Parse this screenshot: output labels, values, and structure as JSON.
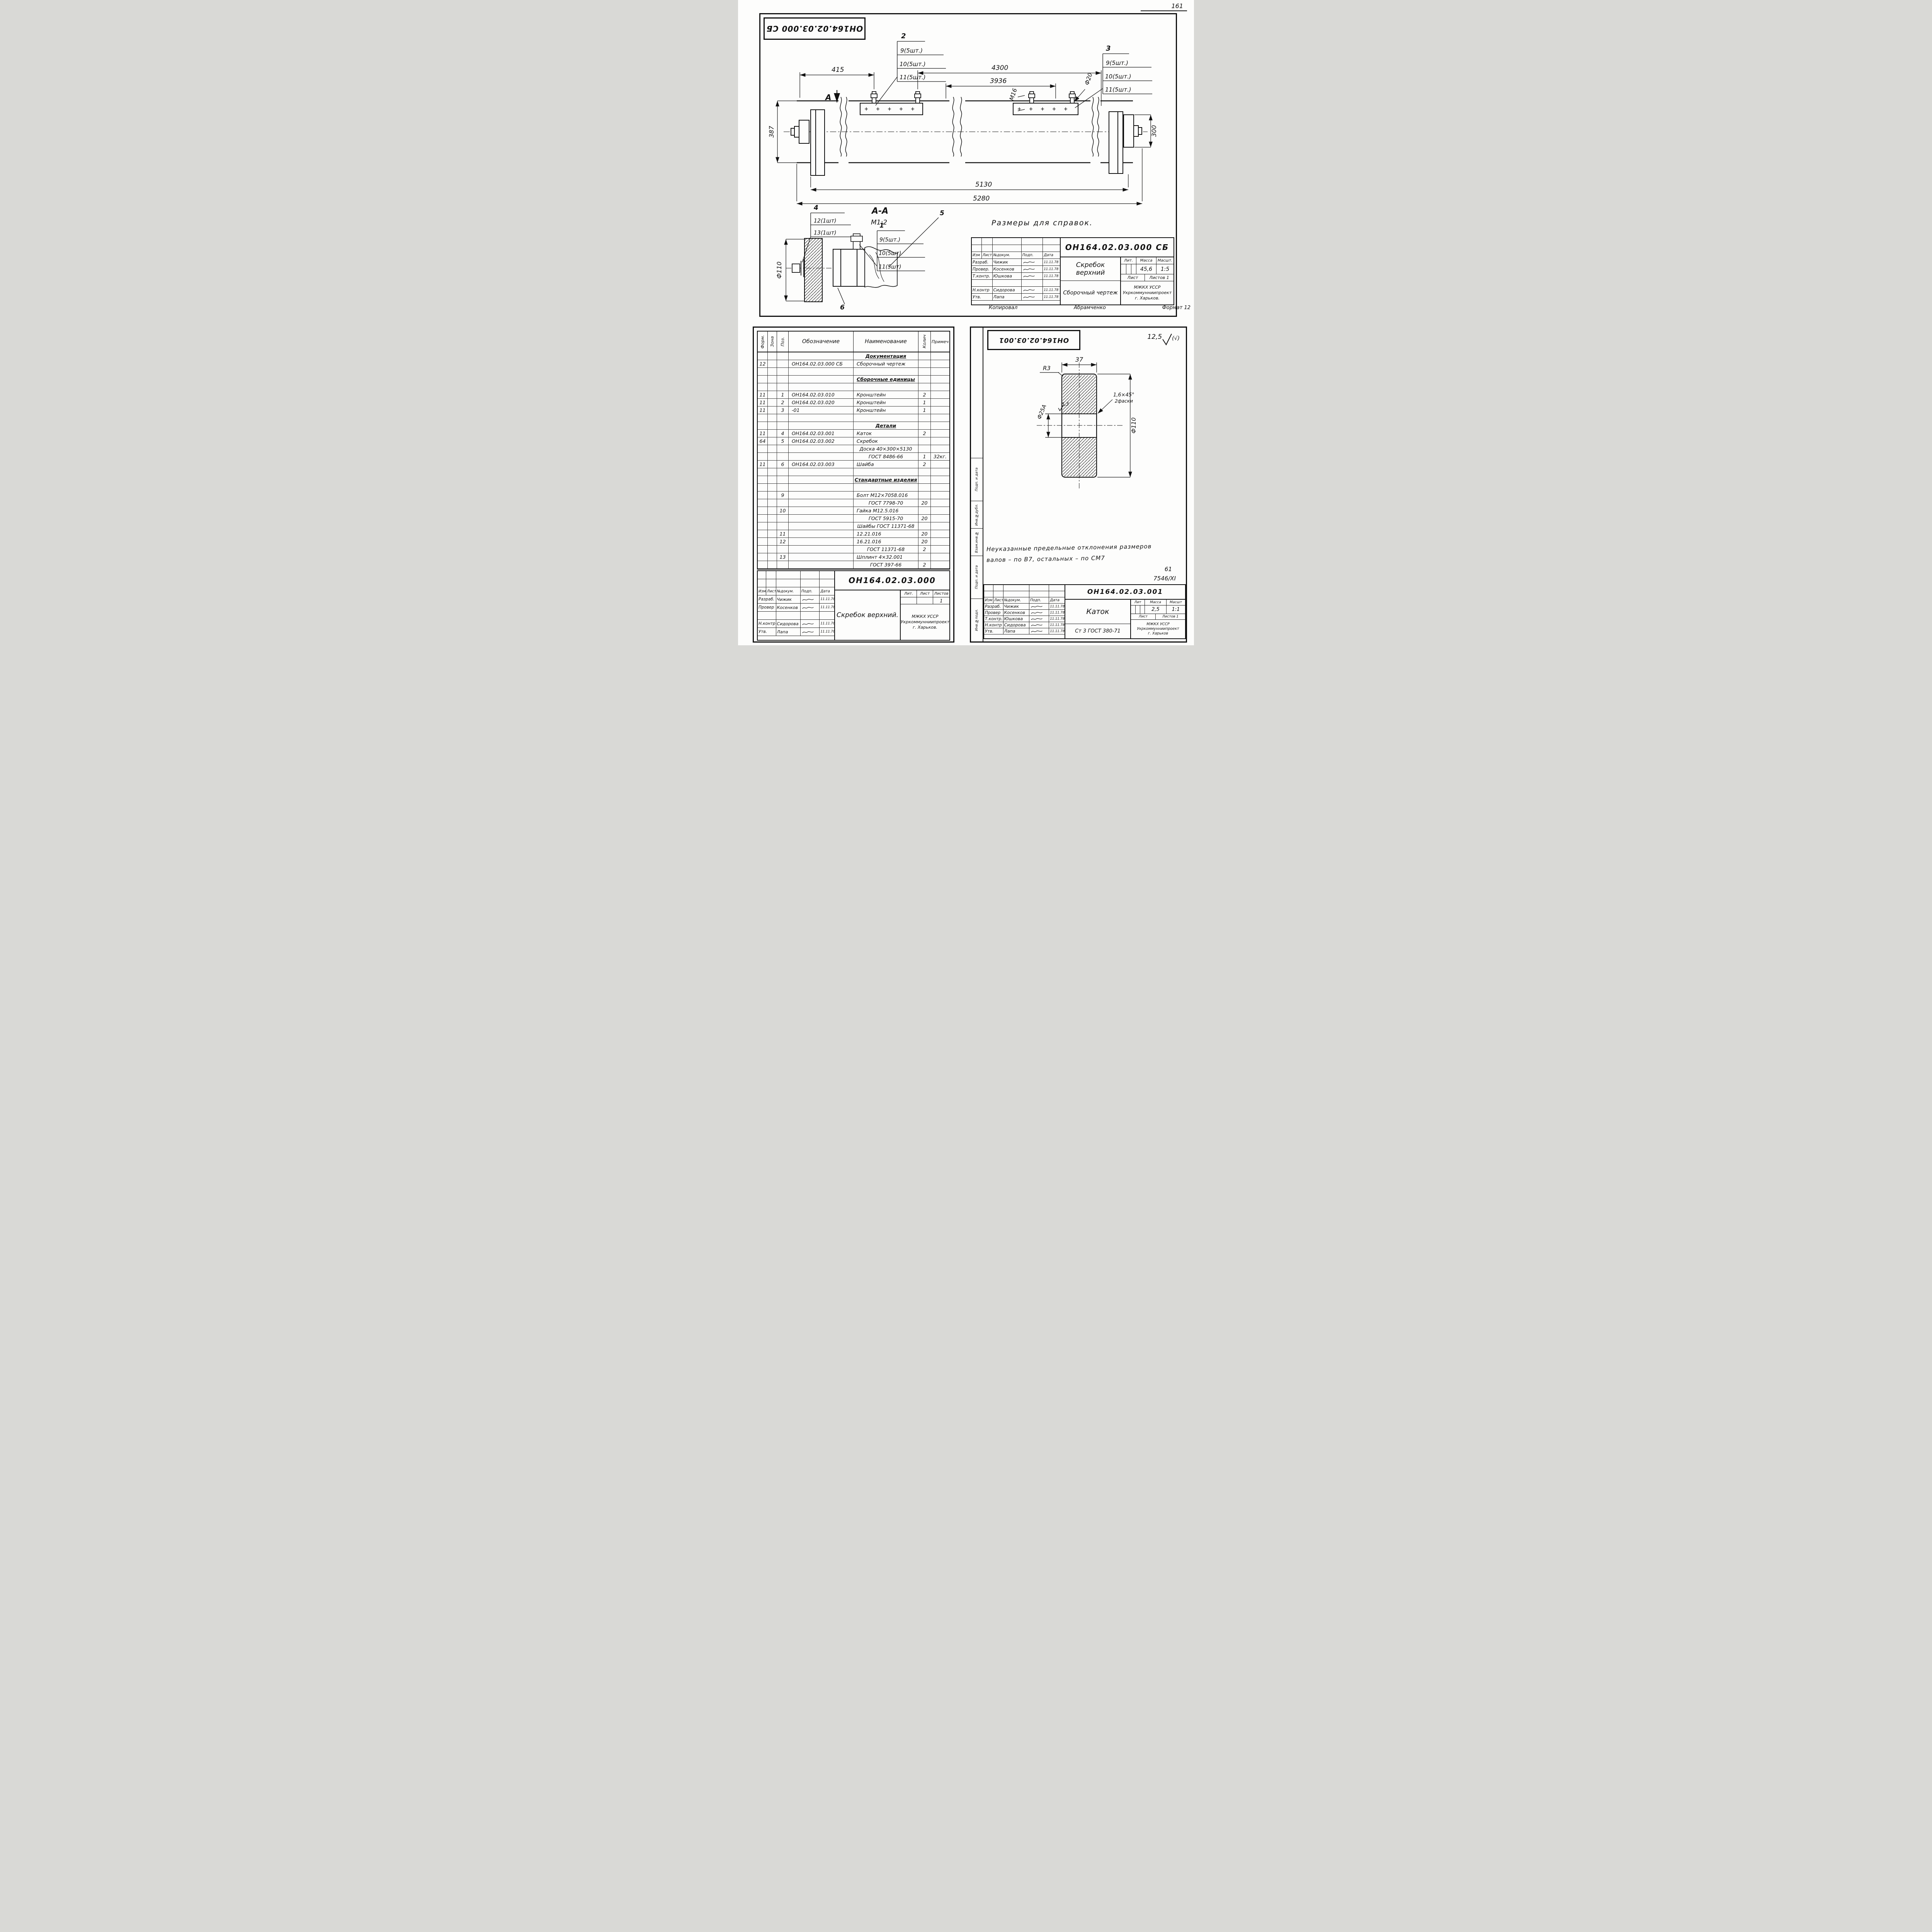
{
  "page": {
    "number": "161"
  },
  "assembly": {
    "stamp": "ОН164.02.03.000 СБ",
    "ref_note": "Размеры для справок.",
    "section_title": "А-А",
    "section_scale": "М1:2",
    "view_marker": "А",
    "dims": {
      "d415": "415",
      "d4300": "4300",
      "d3936": "3936",
      "m16": "М16",
      "f20": "Ф20",
      "d387": "387",
      "d300": "300",
      "d5130": "5130",
      "d5280": "5280",
      "f110": "Ф110"
    },
    "callouts": {
      "c1": {
        "num": "1",
        "lines": [
          "9(5шт.)",
          "10(5шт)",
          "11(5шт)"
        ]
      },
      "c2": {
        "num": "2",
        "lines": [
          "9(5шт.)",
          "10(5шт.)",
          "11(5шт.)"
        ]
      },
      "c3": {
        "num": "3",
        "lines": [
          "9(5шт.)",
          "10(5шт.)",
          "11(5шт.)"
        ]
      },
      "c4": {
        "num": "4",
        "lines": [
          "12(1шт)",
          "13(1шт)"
        ]
      },
      "c5": "5",
      "c6": "6"
    },
    "title_block": {
      "doc_number": "ОН164.02.03.000 СБ",
      "name": "Скребок верхний",
      "doc_type": "Сборочный чертеж",
      "lit_label": "Лит.",
      "mass_label": "Масса",
      "scale_label": "Масшт.",
      "mass": "45,6",
      "scale": "1:5",
      "sheet_label": "Лист",
      "sheets_label": "Листов 1",
      "org_line1": "МЖКХ УССР",
      "org_line2": "Укркоммунниипроект",
      "org_line3": "г. Харьков.",
      "sig": {
        "header": [
          "Изм",
          "Лист",
          "№докум.",
          "Подп.",
          "Дата"
        ],
        "rows": [
          [
            "Разраб.",
            "Чижик",
            "11.11.78"
          ],
          [
            "Провер.",
            "Косенков",
            "11.11.78"
          ],
          [
            "Т.контр.",
            "Юшкова",
            "11.11.78"
          ],
          [
            "",
            "",
            ""
          ],
          [
            "Н.контр",
            "Сидорова",
            "11.11.78"
          ],
          [
            "Утв.",
            "Лапа",
            "11.11.78"
          ]
        ]
      },
      "copied_label": "Копировал",
      "copied_by": "Абрамченко",
      "format_note": "Формат 12"
    }
  },
  "spec": {
    "headers": [
      "Форм.",
      "Зона",
      "Поз.",
      "Обозначение",
      "Наименование",
      "Колич",
      "Примеч"
    ],
    "underline_rows": [
      0,
      3,
      9,
      16
    ],
    "rows": [
      [
        "",
        "",
        "",
        "",
        "Документация",
        "",
        ""
      ],
      [
        "12",
        "",
        "",
        "ОН164.02.03.000 СБ",
        "Сборочный чертеж",
        "",
        ""
      ],
      [
        "",
        "",
        "",
        "",
        "",
        "",
        ""
      ],
      [
        "",
        "",
        "",
        "",
        "Сборочные единицы",
        "",
        ""
      ],
      [
        "",
        "",
        "",
        "",
        "",
        "",
        ""
      ],
      [
        "11",
        "",
        "1",
        "ОН164.02.03.010",
        "Кронштейн",
        "2",
        ""
      ],
      [
        "11",
        "",
        "2",
        "ОН164.02.03.020",
        "Кронштейн",
        "1",
        ""
      ],
      [
        "11",
        "",
        "3",
        "-01",
        "Кронштейн",
        "1",
        ""
      ],
      [
        "",
        "",
        "",
        "",
        "",
        "",
        ""
      ],
      [
        "",
        "",
        "",
        "",
        "Детали",
        "",
        ""
      ],
      [
        "11",
        "",
        "4",
        "ОН164.02.03.001",
        "Каток",
        "2",
        ""
      ],
      [
        "64",
        "",
        "5",
        "ОН164.02.03.002",
        "Скребок",
        "",
        ""
      ],
      [
        "",
        "",
        "",
        "",
        "Доска 40×300×5130",
        "",
        ""
      ],
      [
        "",
        "",
        "",
        "",
        "ГОСТ 8486-66",
        "1",
        "32кг."
      ],
      [
        "11",
        "",
        "6",
        "ОН164.02.03.003",
        "Шайба",
        "2",
        ""
      ],
      [
        "",
        "",
        "",
        "",
        "",
        "",
        ""
      ],
      [
        "",
        "",
        "",
        "",
        "Стандартные изделия",
        "",
        ""
      ],
      [
        "",
        "",
        "",
        "",
        "",
        "",
        ""
      ],
      [
        "",
        "",
        "9",
        "",
        "Болт М12×7058.016",
        "",
        ""
      ],
      [
        "",
        "",
        "",
        "",
        "ГОСТ 7798-70",
        "20",
        ""
      ],
      [
        "",
        "",
        "10",
        "",
        "Гайка М12.5.016",
        "",
        ""
      ],
      [
        "",
        "",
        "",
        "",
        "ГОСТ 5915-70",
        "20",
        ""
      ],
      [
        "",
        "",
        "",
        "",
        "Шайбы ГОСТ 11371-68",
        "",
        ""
      ],
      [
        "",
        "",
        "11",
        "",
        "12.21.016",
        "20",
        ""
      ],
      [
        "",
        "",
        "12",
        "",
        "16.21.016",
        "20",
        ""
      ],
      [
        "",
        "",
        "",
        "",
        "ГОСТ 11371-68",
        "2",
        ""
      ],
      [
        "",
        "",
        "13",
        "",
        "Шплинт 4×32.001",
        "",
        ""
      ],
      [
        "",
        "",
        "",
        "",
        "ГОСТ 397-66",
        "2",
        ""
      ]
    ],
    "title_block": {
      "doc_number": "ОН164.02.03.000",
      "name": "Скребок верхний.",
      "lit_label": "Лит.",
      "sheet_label": "Лист",
      "sheets_label": "Листов",
      "sheets_value": "1",
      "org_line1": "МЖКХ УССР",
      "org_line2": "Укркоммунниипроект",
      "org_line3": "г. Харьков.",
      "sig": {
        "header": [
          "Изм.",
          "Лист",
          "№докум.",
          "Подп.",
          "Дата"
        ],
        "rows": [
          [
            "Разраб.",
            "Чижик",
            "11.11.78"
          ],
          [
            "Провер",
            "Косенков",
            "11.11.78"
          ],
          [
            "",
            "",
            ""
          ],
          [
            "Н.контр",
            "Сидорова",
            "11.11.78"
          ],
          [
            "Утв.",
            "Лапа",
            "11.11.78"
          ]
        ]
      }
    }
  },
  "detail": {
    "stamp": "ОН164.02.03.001",
    "roughness_value": "12,5",
    "roughness_paren": "(√)",
    "dims": {
      "width": "37",
      "radius": "R3",
      "chamfer": "1,6×45°",
      "chamfer_note": "2фаски",
      "bore": "Ф25А",
      "bore_roughness": "6,3",
      "diameter": "Ф110"
    },
    "note_line1": "Неуказанные  предельные  отклонения размеров",
    "note_line2": "валов – по В7, остальных – по СМ7",
    "mark_61": "61",
    "mark_code": "7546/ХI",
    "side_labels": [
      "Инв.№подл.",
      "Подп. и дата",
      "Взам.инв.№",
      "Инв.№дубл.",
      "Подп. и дата"
    ],
    "title_block": {
      "doc_number": "ОН164.02.03.001",
      "name": "Каток",
      "material": "Ст 3 ГОСТ 380-71",
      "lit_label": "Лит",
      "mass_label": "Масса",
      "scale_label": "Масшт",
      "mass": "2,5",
      "scale": "1:1",
      "sheet_label": "Лист",
      "sheets_label": "Листов 1",
      "org_line1": "МЖКХ УССР",
      "org_line2": "Укркоммунниипроект",
      "org_line3": "г. Харьков",
      "sig": {
        "header": [
          "Изм",
          "Лист",
          "№докум.",
          "Подп.",
          "Дата"
        ],
        "rows": [
          [
            "Разраб.",
            "Чижик",
            "11.11.78"
          ],
          [
            "Провер",
            "Косенков",
            "11.11.78"
          ],
          [
            "Т.контр.",
            "Юшкова",
            "11.11.78"
          ],
          [
            "Н.контр",
            "Сидорова",
            "11.11.78"
          ],
          [
            "Утв.",
            "Лапа",
            "11.11.78"
          ]
        ]
      }
    }
  }
}
